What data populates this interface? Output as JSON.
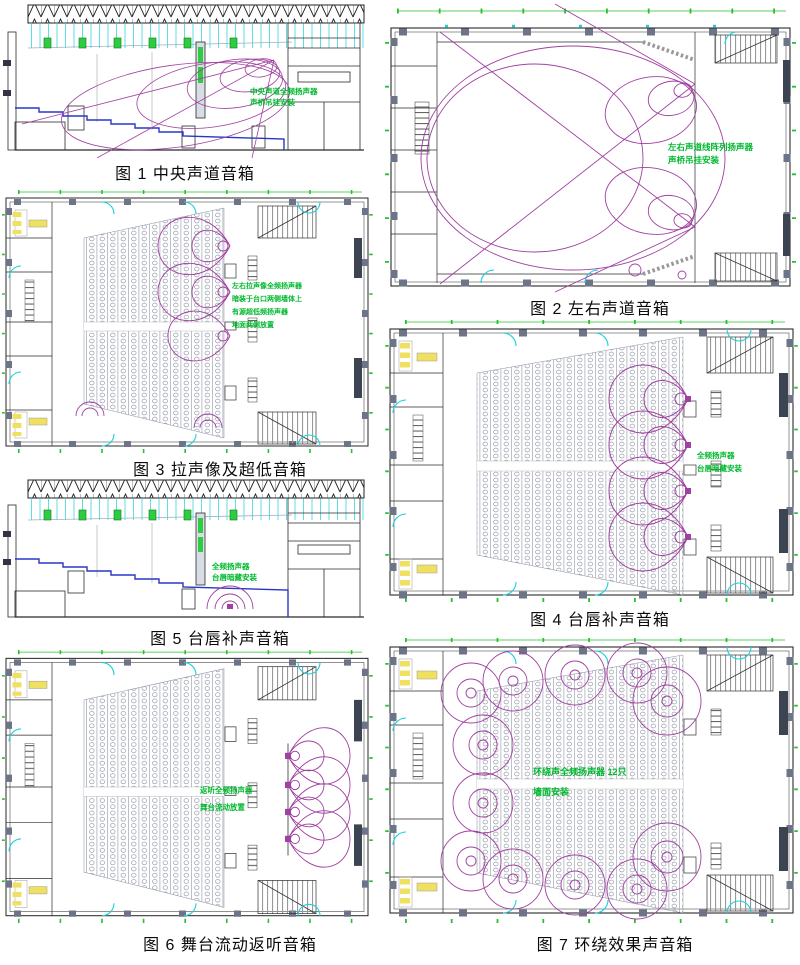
{
  "page": {
    "background": "#ffffff"
  },
  "colors": {
    "line": "#2a2a2a",
    "coverage_purple": "#a040a0",
    "annotation_green": "#00b82e",
    "dimension_green": "#27c02e",
    "door_cyan": "#1ad0da",
    "fixture_yellow": "#f0e060",
    "step_blue": "#2836c8",
    "column_gray": "#6e7487"
  },
  "figures": [
    {
      "id": "fig1",
      "caption": "图 1 中央声道音箱",
      "annotation": [
        "中央声道全频扬声器",
        "声桥吊挂安装"
      ]
    },
    {
      "id": "fig2",
      "caption": "图 2 左右声道音箱",
      "annotation": [
        "左右声道线阵列扬声器",
        "声桥吊挂安装"
      ]
    },
    {
      "id": "fig3",
      "caption": "图 3 拉声像及超低音箱",
      "annotation": [
        "左右拉声像全频扬声器",
        "暗装于台口两侧墙体上",
        "有源超低频扬声器",
        "地面两侧放置"
      ]
    },
    {
      "id": "fig4",
      "caption": "图 4 台唇补声音箱",
      "annotation": [
        "全频扬声器",
        "台唇暗藏安装"
      ]
    },
    {
      "id": "fig5",
      "caption": "图 5 台唇补声音箱",
      "annotation": [
        "全频扬声器",
        "台唇暗藏安装"
      ]
    },
    {
      "id": "fig6",
      "caption": "图 6 舞台流动返听音箱",
      "annotation": [
        "返听全频扬声器",
        "舞台流动放置"
      ]
    },
    {
      "id": "fig7",
      "caption": "图 7 环绕效果声音箱",
      "annotation": [
        "环绕声全频扬声器 12只",
        "墙面安装"
      ]
    }
  ]
}
